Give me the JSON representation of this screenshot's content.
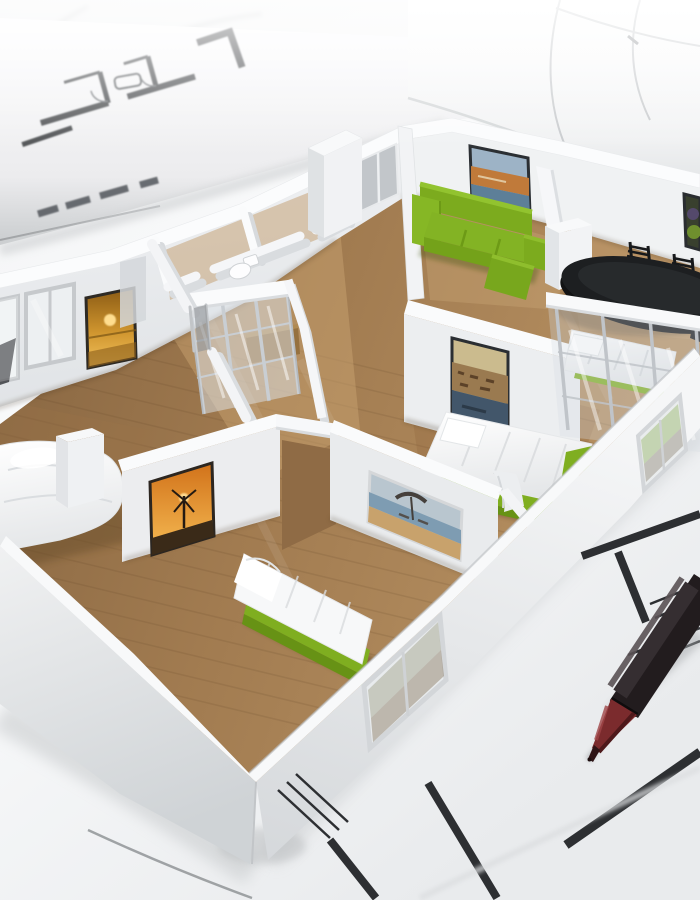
{
  "scene": {
    "alt": "Photorealistic 3D render of a white cutaway apartment floor-plan model with wooden floors, green furniture, beds and framed wall art, standing on architectural blueprint drawings beside rolled-up plans and a ballpoint pen",
    "setting": "architectural blueprints spread on a surface with a rolled plan behind the model",
    "style": "3D architecture visualization photo"
  },
  "objects": {
    "model": "apartment floor-plan scale model",
    "rooms": [
      "living room",
      "dining area",
      "master bedroom",
      "second bedroom",
      "bedroom behind glass partition",
      "bathroom",
      "hallway"
    ],
    "furniture": [
      "green three-seat sofa",
      "green chaise",
      "black oval dining table",
      "black dining chairs",
      "double bed with white duvet",
      "single bed on green base",
      "bed behind glass-framed partition",
      "white bed in left room",
      "glass sliding-door wardrobe",
      "wooden cabinet",
      "toilet"
    ],
    "wall_art": [
      "golden sunset seascape",
      "windmill at sunset",
      "beach with parasol",
      "harbour town",
      "coastal beach scene",
      "fruit still life"
    ],
    "stationery": [
      "rolled blueprint tube",
      "blueprint floor-plan ink drawing",
      "ballpoint pen with red tip"
    ]
  },
  "colors": {
    "paper_white": "#f4f5f6",
    "wall_white": "#f1f2f4",
    "wall_shadow": "#d9dcdf",
    "floor_wood": "#a17b50",
    "floor_wood_light": "#c7a170",
    "sofa_green": "#7cab1e",
    "bed_base_green": "#7fae20",
    "mattress_white": "#f7f8f9",
    "table_black": "#1d1f21",
    "chair_black": "#17191b",
    "pen_body_black": "#221c1e",
    "pen_tip_red": "#7b2b2d",
    "blueprint_ink": "#2d2f32",
    "glass_blue": "#d7dee4",
    "metal_frame": "#b5b9bd",
    "wood_cabinet": "#96713f"
  }
}
